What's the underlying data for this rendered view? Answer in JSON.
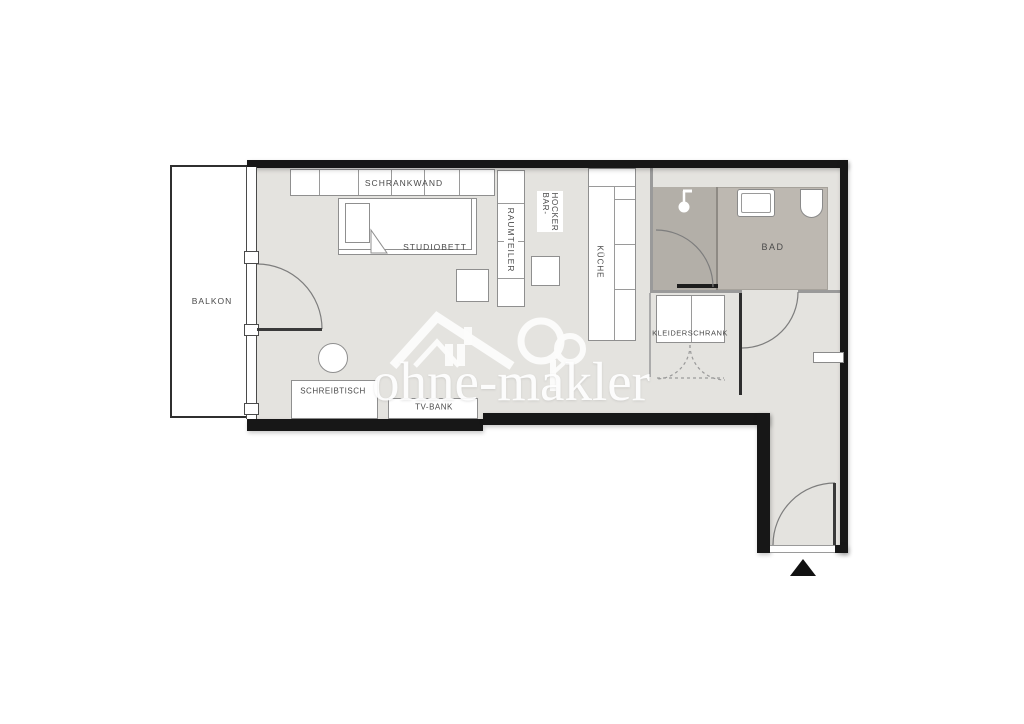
{
  "plan": {
    "type": "apartment-floorplan",
    "labels": {
      "balkon": "BALKON",
      "schrankwand": "SCHRANKWAND",
      "studiobett": "STUDIOBETT",
      "raumteiler": "RAUMTEILER",
      "barhocker_line1": "BAR-",
      "barhocker_line2": "HOCKER",
      "kueche": "KÜCHE",
      "bad": "BAD",
      "kleiderschrank": "KLEIDERSCHRANK",
      "schreibtisch": "SCHREIBTISCH",
      "tvbank": "TV-BANK"
    },
    "watermark": {
      "text": "ohne-makler"
    },
    "colors": {
      "floor": "#e4e3df",
      "bath_floor": "#bdb8b1",
      "shower_floor": "#b3afa8",
      "exterior_wall": "#171717",
      "interior_wall": "#9a9a9a",
      "furniture_border": "#8f8f8f",
      "label_text": "#4a4a4a",
      "watermark": "#ffffff"
    },
    "entrance_marker": "arrow-up-triangle"
  }
}
